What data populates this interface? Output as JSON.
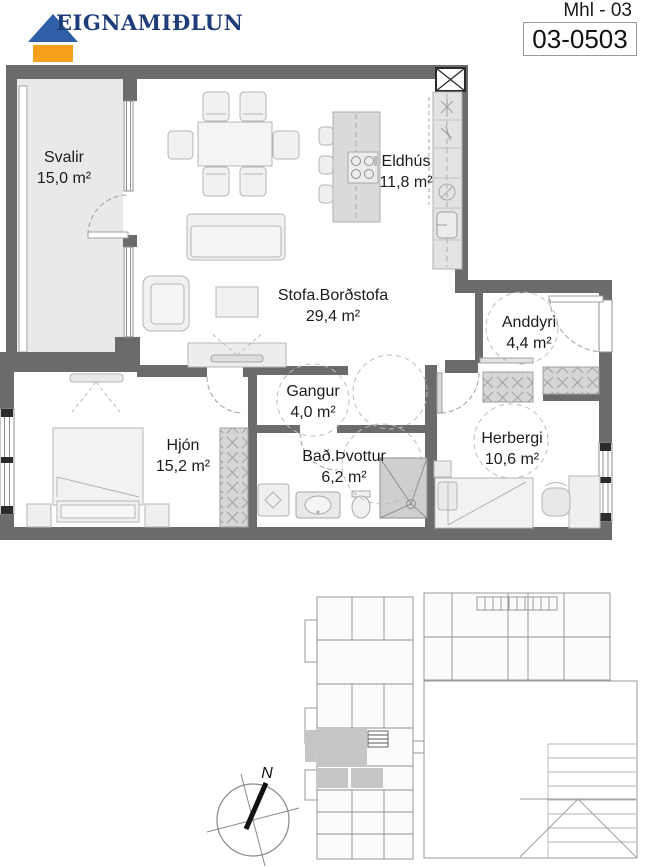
{
  "header": {
    "brand": "EIGNAMIÐLUN",
    "mhl_label": "Mhl - 03",
    "unit_code": "03-0503"
  },
  "rooms": {
    "svalir": {
      "name": "Svalir",
      "area": "15,0 m²"
    },
    "eldhus": {
      "name": "Eldhús",
      "area": "11,8 m²"
    },
    "stofa": {
      "name": "Stofa.Borðstofa",
      "area": "29,4 m²"
    },
    "anddyri": {
      "name": "Anddyri",
      "area": "4,4 m²"
    },
    "gangur": {
      "name": "Gangur",
      "area": "4,0 m²"
    },
    "hjon": {
      "name": "Hjón",
      "area": "15,2 m²"
    },
    "bad": {
      "name": "Bað.Þvottur",
      "area": "6,2 m²"
    },
    "herbergi": {
      "name": "Herbergi",
      "area": "10,6 m²"
    }
  },
  "compass": {
    "north_label": "N"
  },
  "colors": {
    "wall": "#6b6b6b",
    "balcony_fill": "#e9e9e9",
    "furniture_stroke": "#b5b5b5",
    "highlight_unit": "#c6c6c6",
    "logo_blue": "#2e5fa7",
    "logo_orange": "#f6a01b",
    "logo_text_navy": "#1e3c78"
  }
}
